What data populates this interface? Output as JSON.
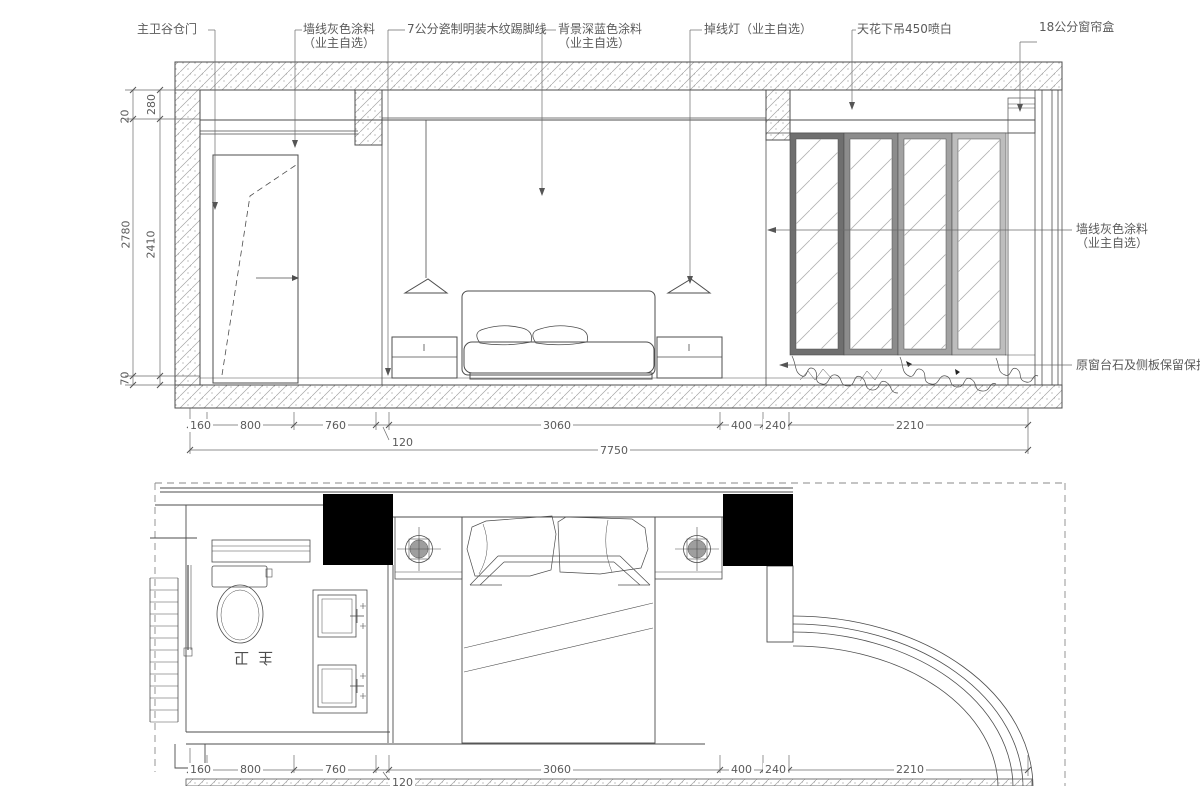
{
  "callouts": {
    "barn_door": "主卫谷仓门",
    "wall_gray_left": "墙线灰色涂料",
    "wall_gray_left_sub": "（业主自选）",
    "skirting": "7公分瓷制明装木纹踢脚线",
    "bg_paint": "背景深蓝色涂料",
    "bg_paint_sub": "（业主自选）",
    "pendant_light": "掉线灯（业主自选）",
    "ceiling_drop": "天花下吊450喷白",
    "curtain_box": "18公分窗帘盒",
    "wall_gray_right": "墙线灰色涂料",
    "wall_gray_right_sub": "（业主自选）",
    "window_sill": "原窗台石及侧板保留保护"
  },
  "elevation": {
    "dim_20": "20",
    "dim_280": "280",
    "dim_2780": "2780",
    "dim_2410": "2410",
    "dim_70": "70",
    "bottom_dims": [
      "160",
      "800",
      "760",
      "120",
      "3060",
      "400",
      "240",
      "2210"
    ],
    "total": "7750"
  },
  "plan": {
    "room_label": "主卫",
    "bottom_dims": [
      "160",
      "800",
      "760",
      "120",
      "3060",
      "400",
      "240",
      "2210"
    ]
  },
  "colors": {
    "line": "#4d4d4d",
    "dim_text": "#5a5a5a",
    "black_fill": "#000000",
    "frame_1": "#6f6f6f",
    "frame_2": "#8c8c8c",
    "frame_3": "#a2a2a2",
    "frame_4": "#bdbdbd",
    "lamp_fill": "#9e9e9e"
  }
}
